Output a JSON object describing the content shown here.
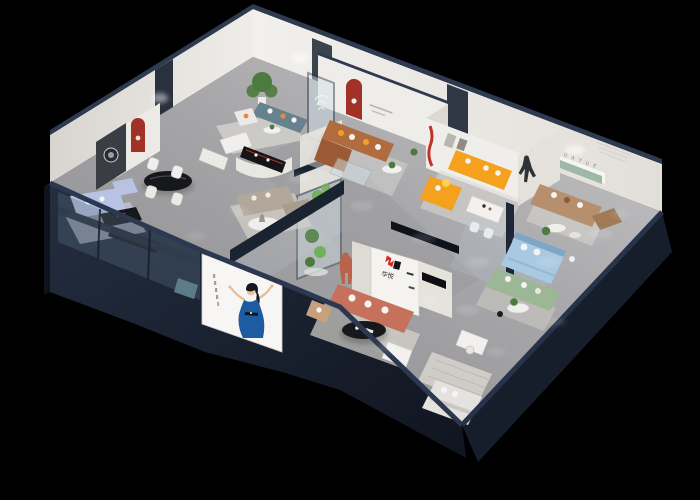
{
  "scene": {
    "description": "isometric 3D cutaway render of a furniture showroom floor plan on black background",
    "brand": {
      "logo_text": "华悦",
      "wall_lettering": "H U A Y U E"
    },
    "palette": {
      "background": "#000000",
      "floor_light": "#C6C6C8",
      "floor_dark": "#87878A",
      "wall_white": "#EDEBE7",
      "wall_shade": "#D9D6D1",
      "navy_wall": "#1F2836",
      "navy_dark": "#141B27",
      "navy_cap": "#2E3A50",
      "glass_tint": "#CFE0EA",
      "sofa_teal": "#67828F",
      "sofa_caramel": "#B06B3F",
      "sofa_caramel_dark": "#9C5A34",
      "sofa_orange": "#F4A11D",
      "sofa_salmon": "#C5715B",
      "sofa_periwinkle": "#B8C3E3",
      "sofa_sage": "#9CB795",
      "sofa_tan": "#B6906E",
      "sofa_greige": "#B3A79B",
      "bed_blue": "#A9C8E2",
      "niche_red": "#A23127",
      "accent_red": "#D6281F",
      "logo_ink": "#15161A",
      "plant_green": "#4D7A3E",
      "cactus_green": "#72B05C",
      "shelf_green": "#9DB9A6",
      "dress_blue": "#1D5CA1",
      "mannequin_terracotta": "#B9644A",
      "lettering_gray": "#8F8C86",
      "rug": "#D6D2CB",
      "table_black": "#17181B",
      "white": "#F4F3F1"
    }
  }
}
